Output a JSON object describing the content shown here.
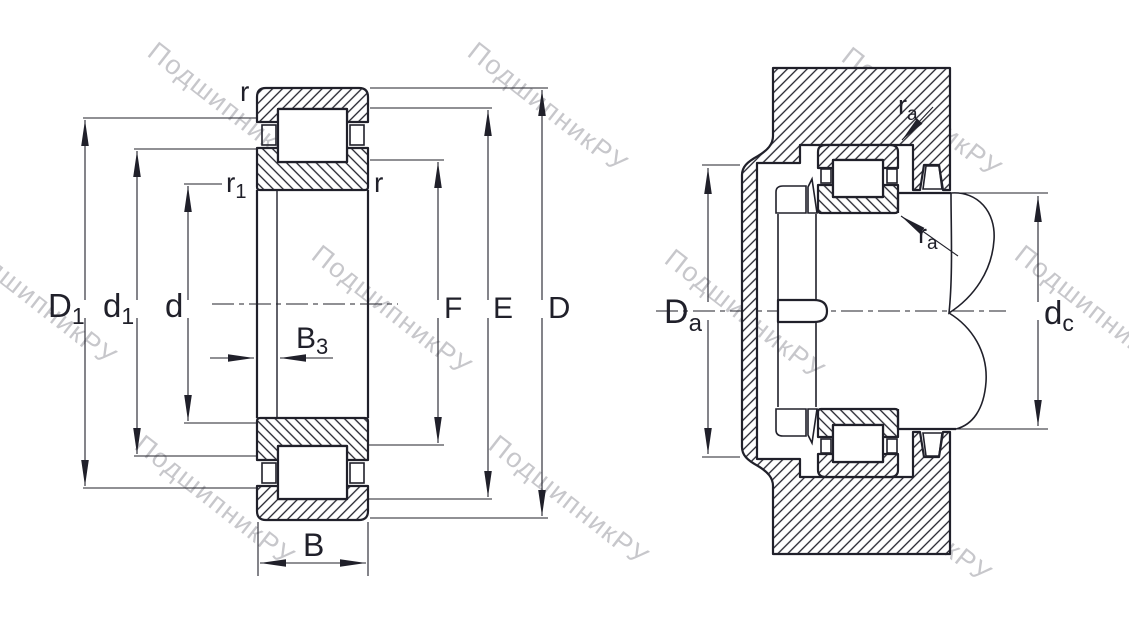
{
  "drawing_type": "bearing engineering drawing (cylindrical roller bearing cross-section and mounting arrangement)",
  "colors": {
    "line": "#20202a",
    "background": "#ffffff",
    "watermark": "#c7c7cb"
  },
  "watermark": {
    "text": "ПодшипникРУ"
  },
  "views": {
    "left": {
      "name": "bearing-cross-section",
      "labels": {
        "r_top": {
          "main": "r",
          "sub": ""
        },
        "r1": {
          "main": "r",
          "sub": "1"
        },
        "r_inner": {
          "main": "r",
          "sub": ""
        },
        "D1": {
          "main": "D",
          "sub": "1"
        },
        "d1": {
          "main": "d",
          "sub": "1"
        },
        "d": {
          "main": "d",
          "sub": ""
        },
        "B3": {
          "main": "B",
          "sub": "3"
        },
        "B": {
          "main": "B",
          "sub": ""
        },
        "F": {
          "main": "F",
          "sub": ""
        },
        "E": {
          "main": "E",
          "sub": ""
        },
        "D": {
          "main": "D",
          "sub": ""
        }
      }
    },
    "right": {
      "name": "mounting-arrangement",
      "labels": {
        "Da": {
          "main": "D",
          "sub": "a"
        },
        "dc": {
          "main": "d",
          "sub": "c"
        },
        "ra_top": {
          "main": "r",
          "sub": "a"
        },
        "ra_bottom": {
          "main": "r",
          "sub": "a"
        }
      }
    }
  }
}
